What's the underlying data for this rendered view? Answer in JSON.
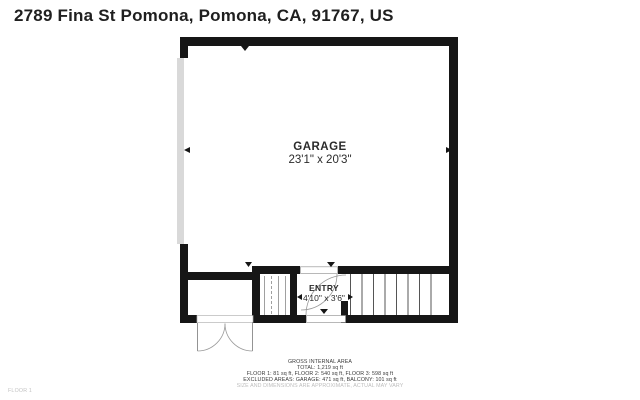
{
  "title": "2789 Fina St Pomona, Pomona, CA, 91767, US",
  "floor_plan": {
    "rooms": [
      {
        "name": "GARAGE",
        "dimensions": "23'1\" x 20'3\""
      },
      {
        "name": "ENTRY",
        "dimensions": "4'10\" x 3'6\""
      }
    ],
    "features": [
      "garage-door",
      "entry-door",
      "porch-double-door",
      "staircase",
      "small-stairs"
    ]
  },
  "footer": {
    "heading": "GROSS INTERNAL AREA",
    "total": "TOTAL: 1,219 sq ft",
    "floors": "FLOOR 1: 81 sq ft, FLOOR 2: 540 sq ft, FLOOR 3: 598 sq ft",
    "excluded": "EXCLUDED AREAS: GARAGE: 471 sq ft, BALCONY: 101 sq ft",
    "disclaimer": "SIZE AND DIMENSIONS ARE APPROXIMATE, ACTUAL MAY VARY"
  },
  "floor_label": "FLOOR 1",
  "colors": {
    "wall": "#161616",
    "garage_door": "#d9d9d9",
    "stair_line": "#555555",
    "door_arc": "#999999",
    "muted_text": "#bdbdbd"
  }
}
